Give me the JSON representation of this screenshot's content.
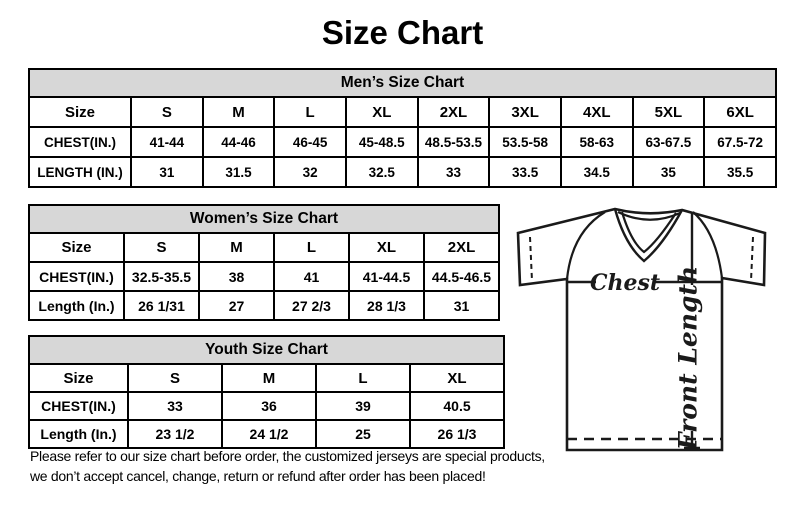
{
  "page": {
    "title": "Size Chart"
  },
  "tables": {
    "mens": {
      "title": "Men’s Size Chart",
      "rows": [
        [
          "Size",
          "S",
          "M",
          "L",
          "XL",
          "2XL",
          "3XL",
          "4XL",
          "5XL",
          "6XL"
        ],
        [
          "CHEST(IN.)",
          "41-44",
          "44-46",
          "46-45",
          "45-48.5",
          "48.5-53.5",
          "53.5-58",
          "58-63",
          "63-67.5",
          "67.5-72"
        ],
        [
          "LENGTH (IN.)",
          "31",
          "31.5",
          "32",
          "32.5",
          "33",
          "33.5",
          "34.5",
          "35",
          "35.5"
        ]
      ]
    },
    "womens": {
      "title": "Women’s Size Chart",
      "rows": [
        [
          "Size",
          "S",
          "M",
          "L",
          "XL",
          "2XL"
        ],
        [
          "CHEST(IN.)",
          "32.5-35.5",
          "38",
          "41",
          "41-44.5",
          "44.5-46.5"
        ],
        [
          "Length (In.)",
          "26 1/31",
          "27",
          "27 2/3",
          "28 1/3",
          "31"
        ]
      ]
    },
    "youth": {
      "title": "Youth Size Chart",
      "rows": [
        [
          "Size",
          "S",
          "M",
          "L",
          "XL"
        ],
        [
          "CHEST(IN.)",
          "33",
          "36",
          "39",
          "40.5"
        ],
        [
          "Length (In.)",
          "23 1/2",
          "24 1/2",
          "25",
          "26 1/3"
        ]
      ]
    }
  },
  "disclaimer": {
    "line1": "Please refer to our size chart before order, the customized jerseys are special products,",
    "line2": "we don’t accept cancel, change, return or refund after order has been placed!"
  },
  "diagram": {
    "chest_label": "Chest",
    "front_length_label": "Front Length"
  },
  "colors": {
    "background": "#ffffff",
    "table_header_bg": "#d7d7d7",
    "border": "#000000",
    "line": "#1a1a1a"
  }
}
